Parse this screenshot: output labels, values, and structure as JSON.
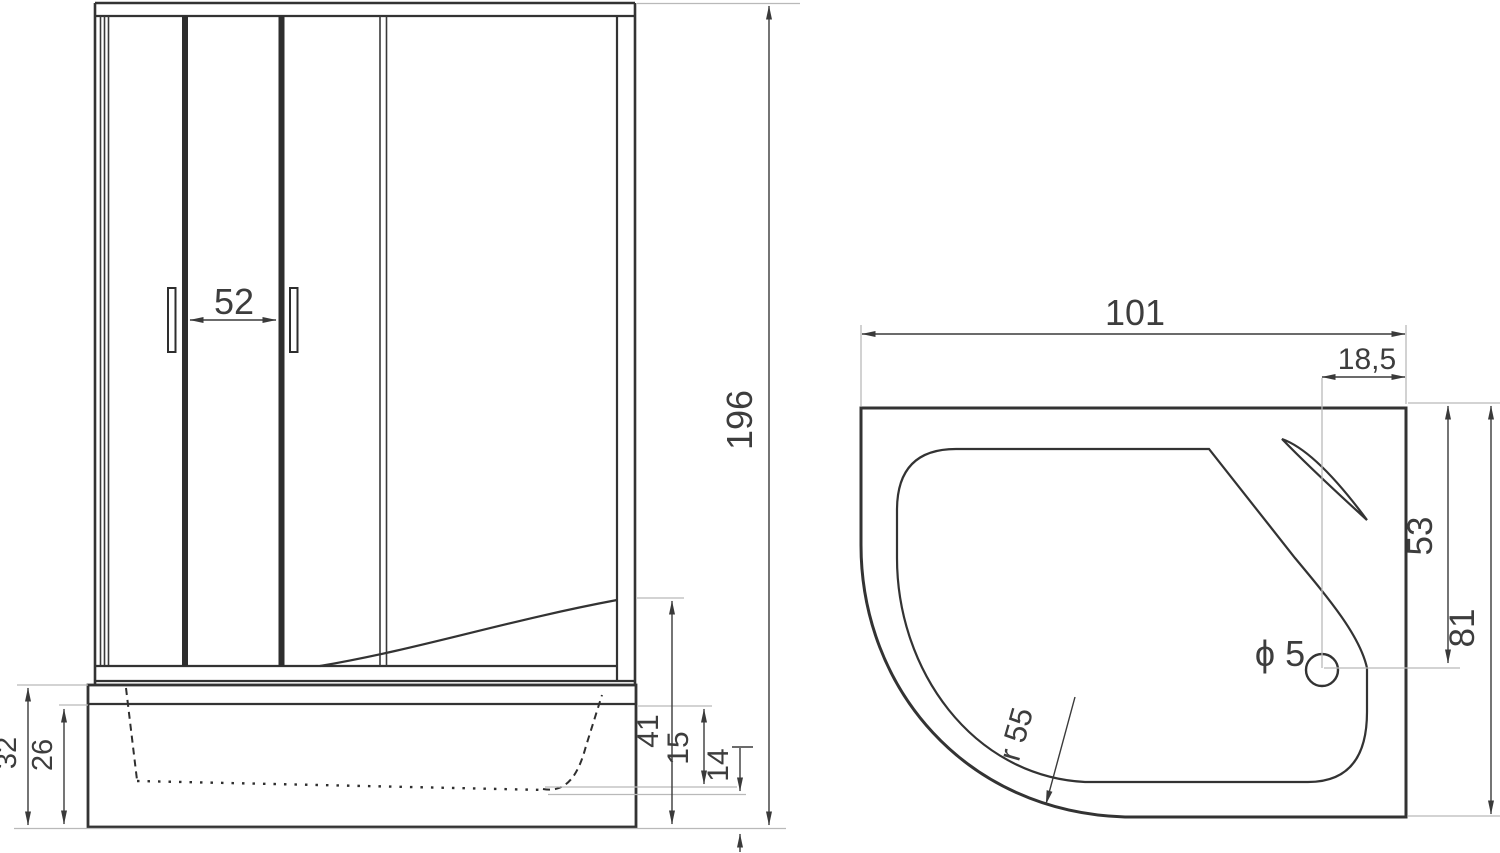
{
  "drawing": {
    "front_view": {
      "door_width": "52",
      "overall_height": "196",
      "tray_total_height": "32",
      "tray_panel_height": "26",
      "rim_to_floor": "41",
      "basin_inner_depth": "15",
      "basin_floor_clearance": "14"
    },
    "top_view": {
      "overall_width": "101",
      "drain_center_offset": "18,5",
      "drain_center_depth": "53",
      "overall_depth": "81",
      "corner_radius": "r 55",
      "drain_diameter": "ϕ 5"
    },
    "colors": {
      "line": "#333333",
      "dimension": "#3a3a3a",
      "extension": "#b9b9b9",
      "background": "#ffffff"
    }
  }
}
